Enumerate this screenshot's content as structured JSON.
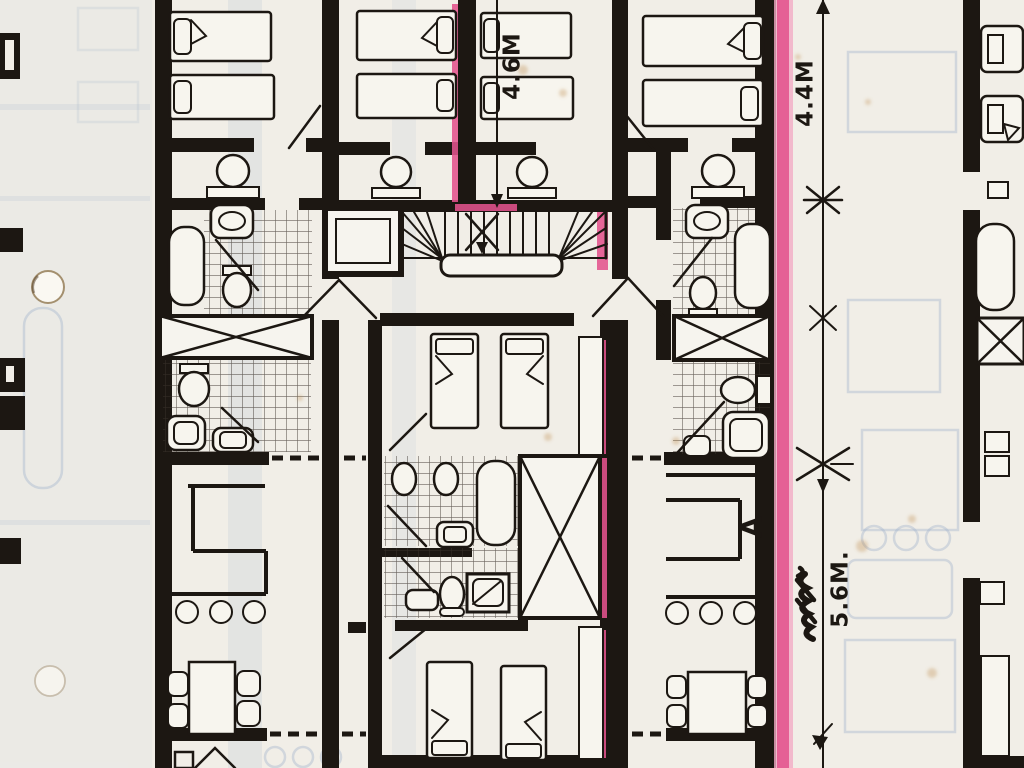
{
  "annotations": {
    "top_center_dimension": "4.6M",
    "right_upper_dimension": "4.4M",
    "right_lower_dimension": "5.6M.",
    "room_letter": "A"
  },
  "colors": {
    "paper": "#f1eee7",
    "ink": "#1c1712",
    "highlight_pink": "#e2538d",
    "highlight_pink_light": "#f2abc6",
    "ghost_showthrough": "#a5b6cc",
    "age_spot": "#bb8a48"
  }
}
